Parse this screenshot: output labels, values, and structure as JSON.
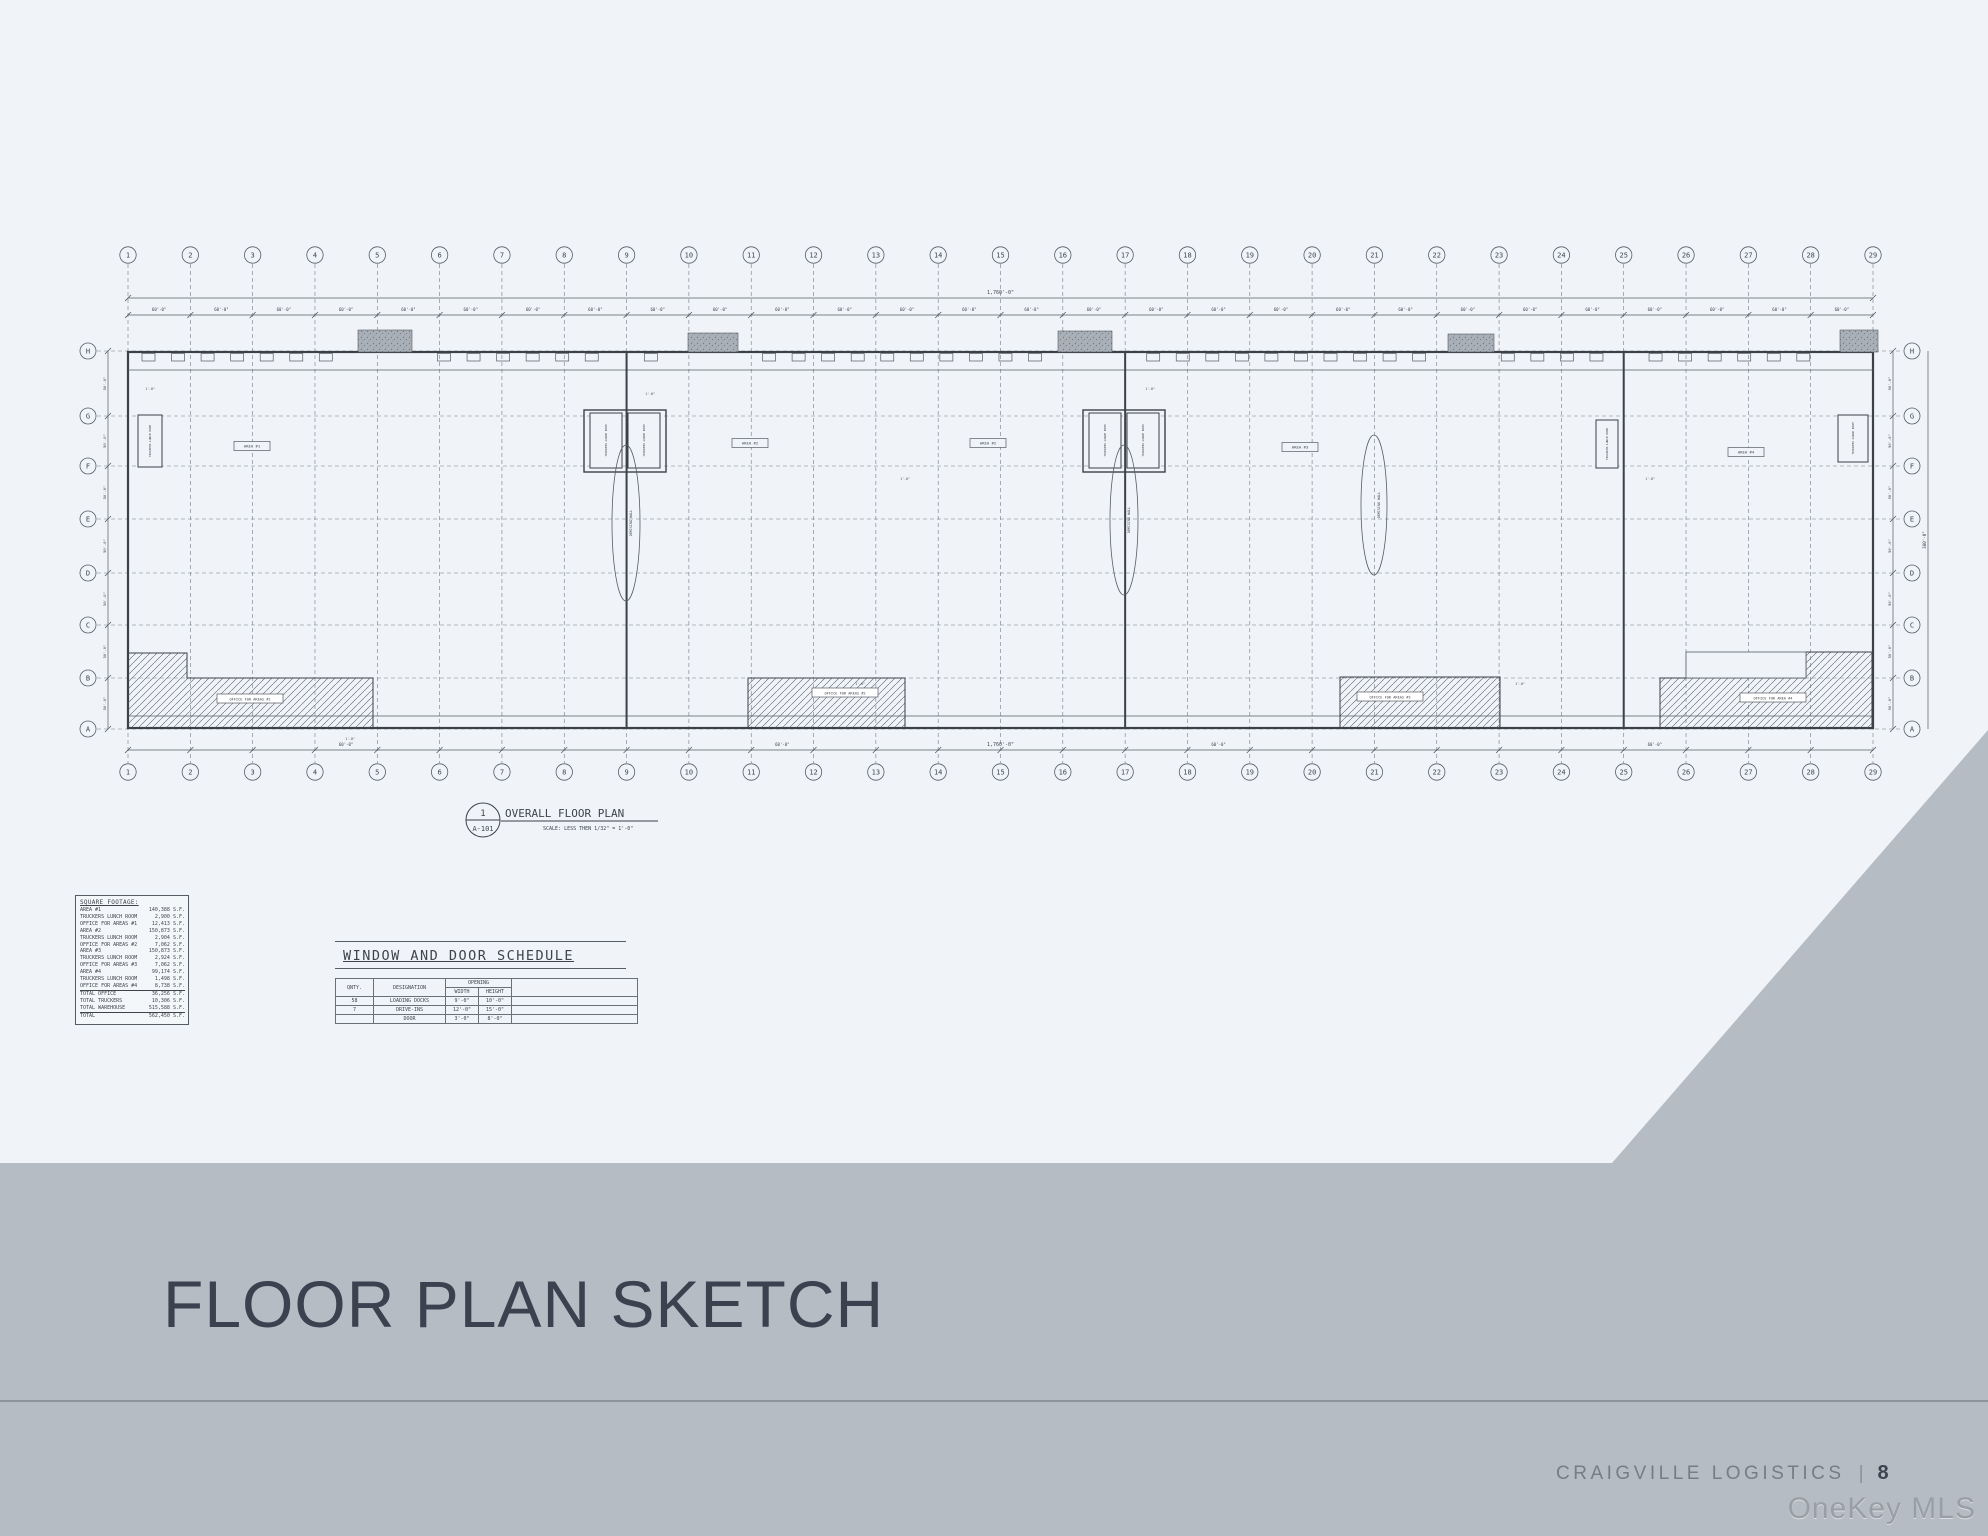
{
  "page": {
    "band_color": "#b5bcc4",
    "title": "FLOOR PLAN SKETCH",
    "footer": {
      "brand": "CRAIGVILLE LOGISTICS",
      "divider": "|",
      "page_number": "8"
    },
    "watermark": "OneKey MLS"
  },
  "plan": {
    "columns": [
      "1",
      "2",
      "3",
      "4",
      "5",
      "6",
      "7",
      "8",
      "9",
      "10",
      "11",
      "12",
      "13",
      "14",
      "15",
      "16",
      "17",
      "18",
      "19",
      "20",
      "21",
      "22",
      "23",
      "24",
      "25",
      "26",
      "27",
      "28",
      "29"
    ],
    "rows": [
      "H",
      "G",
      "F",
      "E",
      "D",
      "C",
      "B",
      "A"
    ],
    "title_ref": {
      "detail_number": "1",
      "sheet": "A-101",
      "title": "OVERALL FLOOR PLAN",
      "scale": "SCALE: LESS THEN 1/32\" = 1'-0\""
    },
    "bay_dim": "60'-0\"",
    "overall_dim": "1,760'-0\"",
    "side_bay_dim": "50'-0\"",
    "side_overall_dim": "380'-0\"",
    "small_dim": "1'-0\"",
    "area_labels": [
      "AREA #1",
      "AREA #2",
      "AREA #2",
      "AREA #3",
      "AREA #4"
    ],
    "office_labels": [
      "OFFICE FOR AREAS #1",
      "OFFICE FOR AREAS #2",
      "OFFICE FOR AREAS #3",
      "OFFICE FOR AREA #4"
    ],
    "lunch_room_label": "TRUCKERS LUNCH ROOM",
    "demising_label": "DEMISING WALL"
  },
  "square_footage": {
    "title": "SQUARE FOOTAGE:",
    "unit": "S.F.",
    "rows": [
      {
        "label": "AREA #1",
        "value": "140,388 S.F.",
        "underline": false
      },
      {
        "label": "TRUCKERS LUNCH ROOM",
        "value": "2,900 S.F.",
        "underline": false
      },
      {
        "label": "OFFICE FOR AREAS #1",
        "value": "12,413 S.F.",
        "underline": false
      },
      {
        "label": "AREA #2",
        "value": "150,873 S.F.",
        "underline": false
      },
      {
        "label": "TRUCKERS LUNCH ROOM",
        "value": "2,904 S.F.",
        "underline": false
      },
      {
        "label": "OFFICE FOR AREAS #2",
        "value": "7,062 S.F.",
        "underline": false
      },
      {
        "label": "AREA #3",
        "value": "150,873 S.F.",
        "underline": false
      },
      {
        "label": "TRUCKERS LUNCH ROOM",
        "value": "2,924 S.F.",
        "underline": false
      },
      {
        "label": "OFFICE FOR AREAS #3",
        "value": "7,062 S.F.",
        "underline": false
      },
      {
        "label": "AREA #4",
        "value": "99,174 S.F.",
        "underline": false
      },
      {
        "label": "TRUCKERS LUNCH ROOM",
        "value": "1,498 S.F.",
        "underline": false
      },
      {
        "label": "OFFICE FOR AREAS #4",
        "value": "8,738 S.F.",
        "underline": true
      },
      {
        "label": "TOTAL OFFICE",
        "value": "36,256 S.F.",
        "underline": false
      },
      {
        "label": "TOTAL TRUCKERS",
        "value": "10,306 S.F.",
        "underline": false
      },
      {
        "label": "TOTAL WAREHOUSE",
        "value": "515,588 S.F.",
        "underline": true
      },
      {
        "label": "TOTAL",
        "value": "562,450 S.F.",
        "underline": false
      }
    ]
  },
  "schedule": {
    "title": "WINDOW AND DOOR SCHEDULE",
    "headers": {
      "qnty": "QNTY.",
      "designation": "DESIGNATION",
      "opening": "OPENING",
      "width": "WIDTH",
      "height": "HEIGHT"
    },
    "rows": [
      {
        "qnty": "58",
        "designation": "LOADING DOCKS",
        "width": "9'-0\"",
        "height": "10'-0\""
      },
      {
        "qnty": "7",
        "designation": "DRIVE-INS",
        "width": "12'-0\"",
        "height": "15'-0\""
      },
      {
        "qnty": "",
        "designation": "DOOR",
        "width": "3'-0\"",
        "height": "8'-0\""
      }
    ]
  }
}
